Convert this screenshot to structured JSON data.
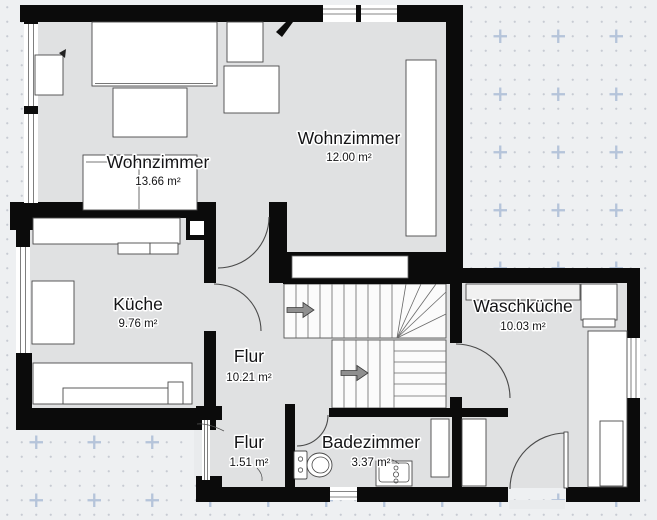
{
  "app": {
    "view": "floor-plan-canvas",
    "floor_fill": "#e0e1e2",
    "wall_color": "#0b0b0b",
    "background": "#eef0f2",
    "grid_dot_color": "#c7cbd3",
    "grid_cross_color": "#b5c4da"
  },
  "rooms": [
    {
      "id": "wohnzimmer-links",
      "name": "Wohnzimmer",
      "area": "13.66 m²"
    },
    {
      "id": "wohnzimmer-rechts",
      "name": "Wohnzimmer",
      "area": "12.00 m²"
    },
    {
      "id": "kueche",
      "name": "Küche",
      "area": "9.76 m²"
    },
    {
      "id": "waschkueche",
      "name": "Waschküche",
      "area": "10.03 m²"
    },
    {
      "id": "flur",
      "name": "Flur",
      "area": "10.21 m²"
    },
    {
      "id": "flur-klein",
      "name": "Flur",
      "area": "1.51 m²"
    },
    {
      "id": "badezimmer",
      "name": "Badezimmer",
      "area": "3.37 m²"
    }
  ]
}
